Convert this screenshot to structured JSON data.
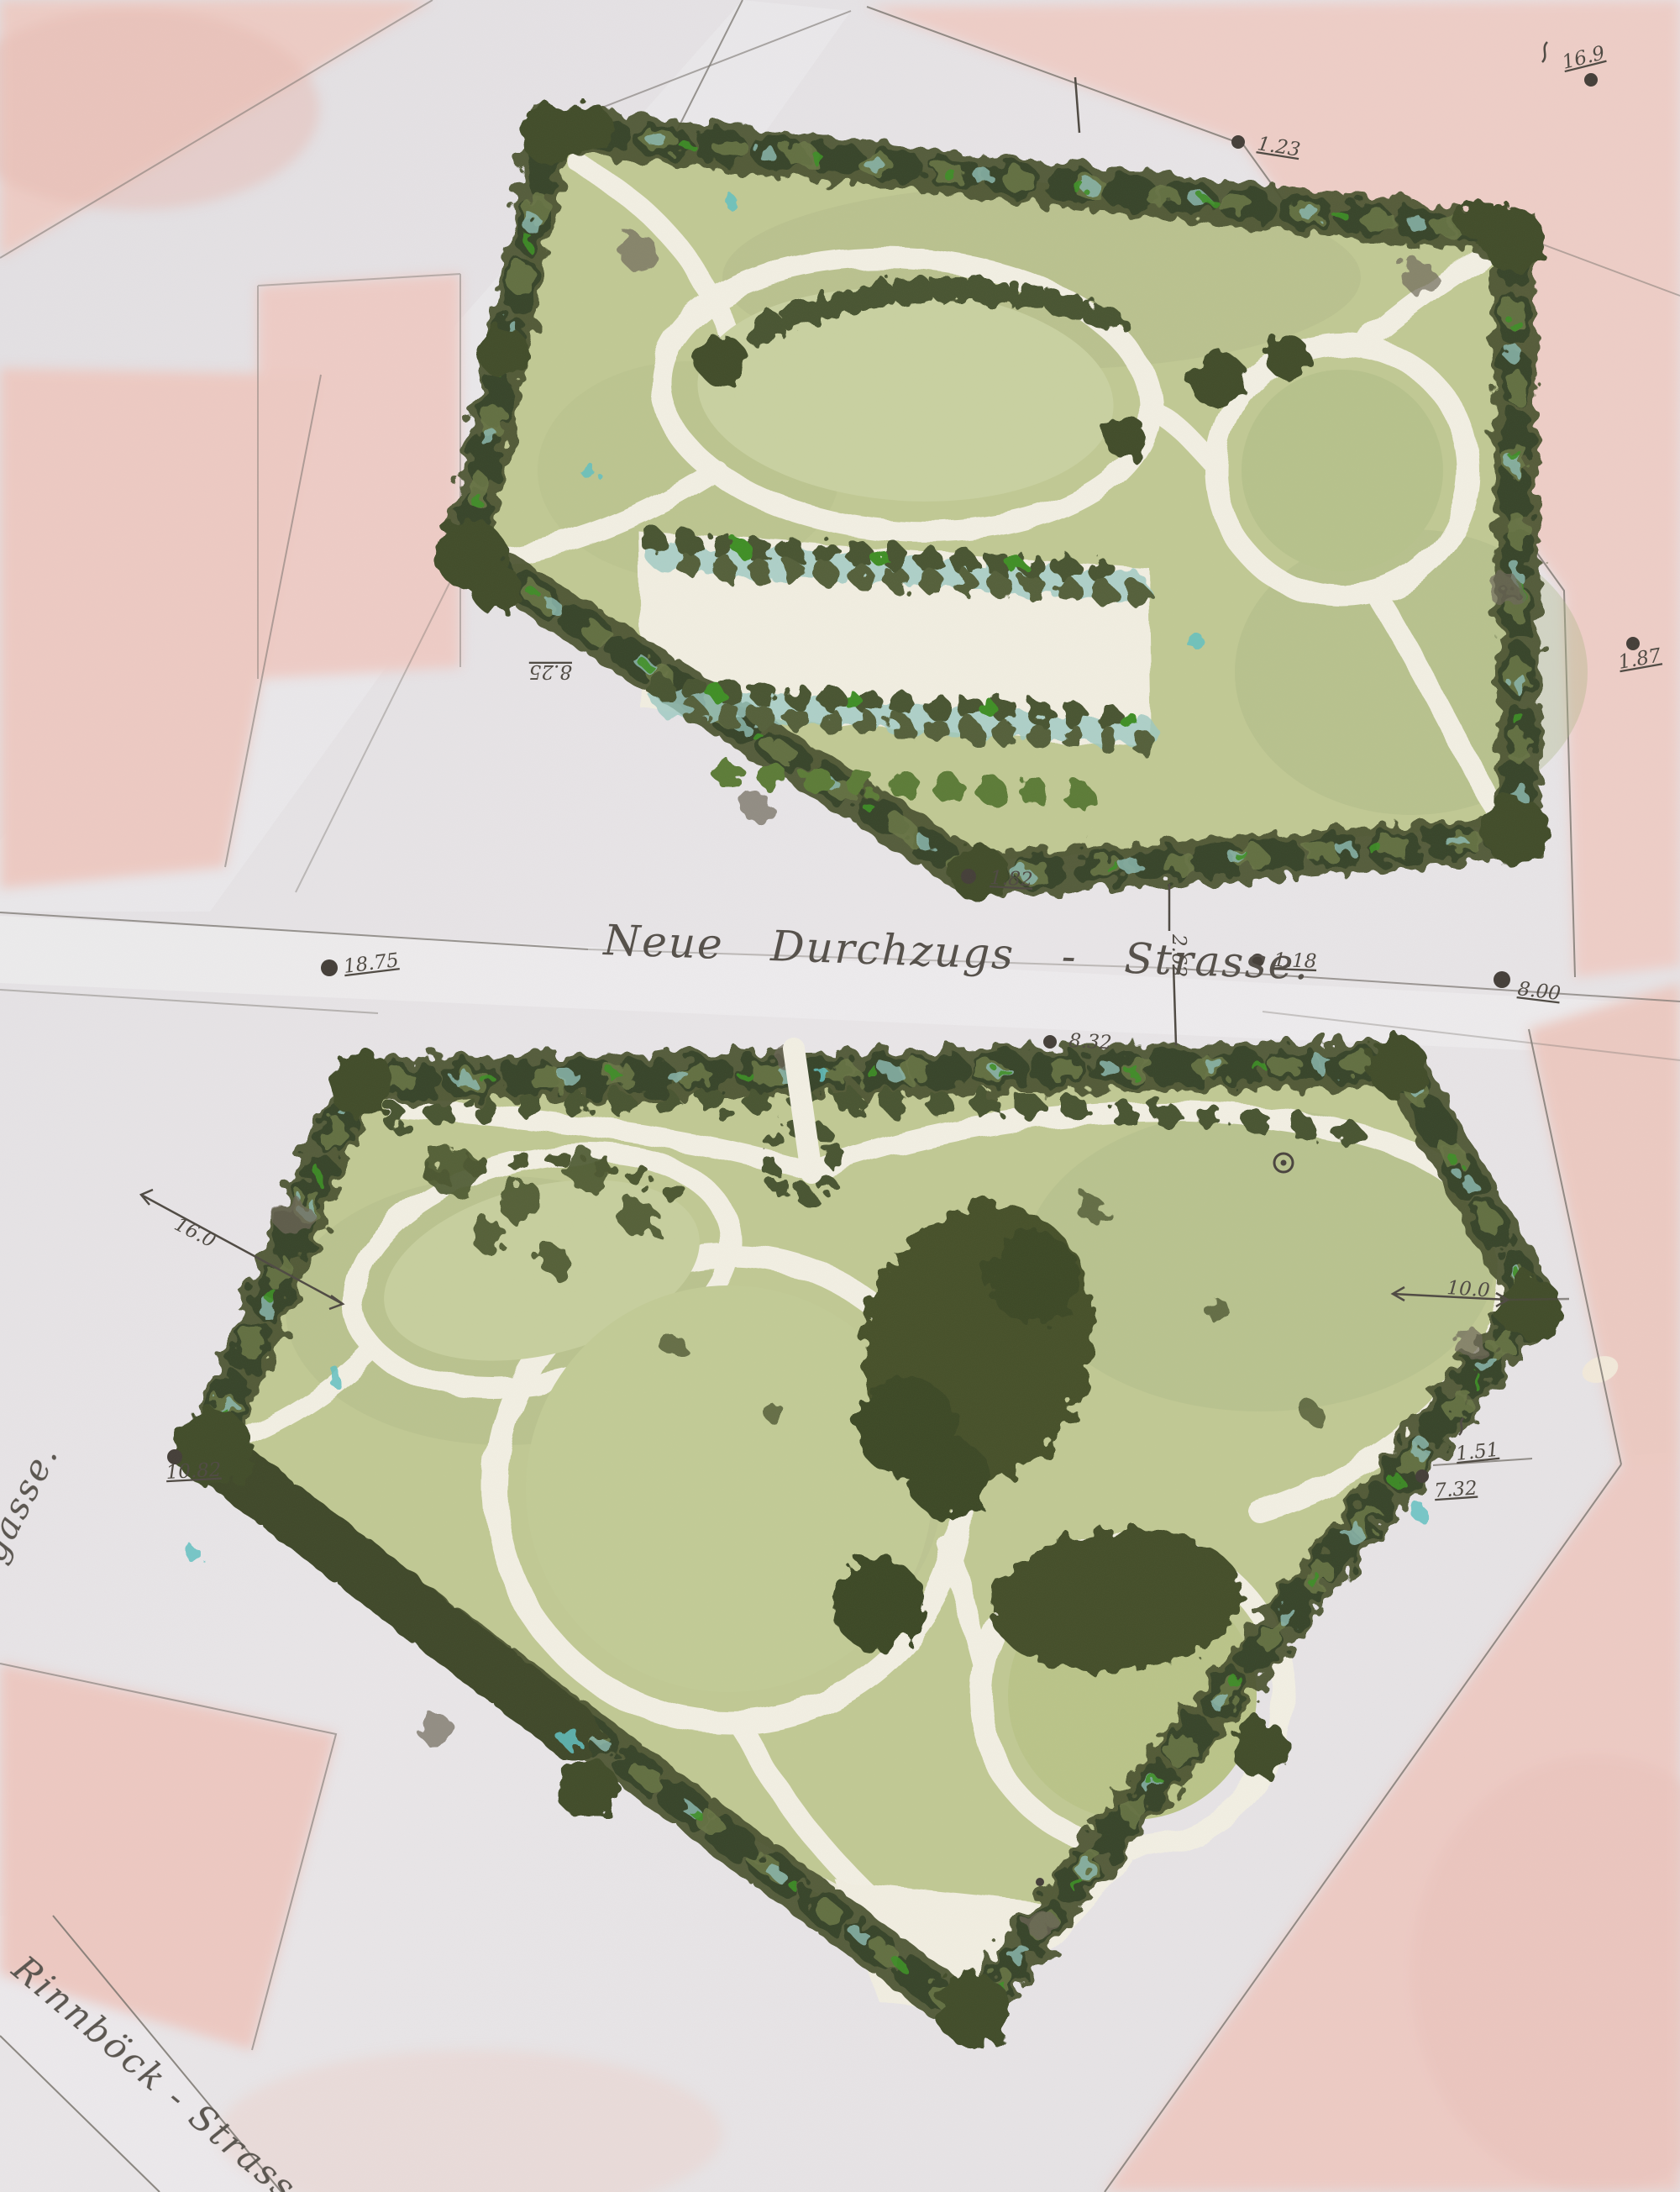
{
  "document": {
    "title": "Hand-coloured park layout plan with two garden parcels",
    "labels": {
      "street_main": "Neue Durchzugs - Strasse.",
      "street_left": "ayergasse.",
      "street_bottom": "Rinnböck - Strasse."
    },
    "markers": {
      "top_center": "1.23",
      "top_right": "16.9",
      "left_upper": "8.25",
      "right_upper": "1.87",
      "below_park1": "1.82",
      "street_left_pt": "18.75",
      "street_mid_pt": "1.18",
      "street_right_pt": "8.00",
      "street_width": "2.62",
      "park2_top": "8.32",
      "park2_left": "10.82",
      "right_mid_a": "1.51",
      "right_mid_b": "7.32",
      "dim_left": "16.0",
      "dim_right": "10.0"
    },
    "colors": {
      "paper": "#e8e5e7",
      "street_light": "#edebec",
      "block_pink": "#eecfc8",
      "block_pink_deep": "#e9c2ba",
      "lawn": "#c1c994",
      "lawn_light": "#c9d1a1",
      "tree_dark": "#49522f",
      "tree_deep": "#39452a",
      "tree_light": "#6e7a4a",
      "accent_green": "#3f8f28",
      "teal": "#8fbdb4",
      "teal_bright": "#63c1c1",
      "path_cream": "#f2efe3",
      "line": "#7a756f",
      "ink": "#4f4a43"
    }
  }
}
